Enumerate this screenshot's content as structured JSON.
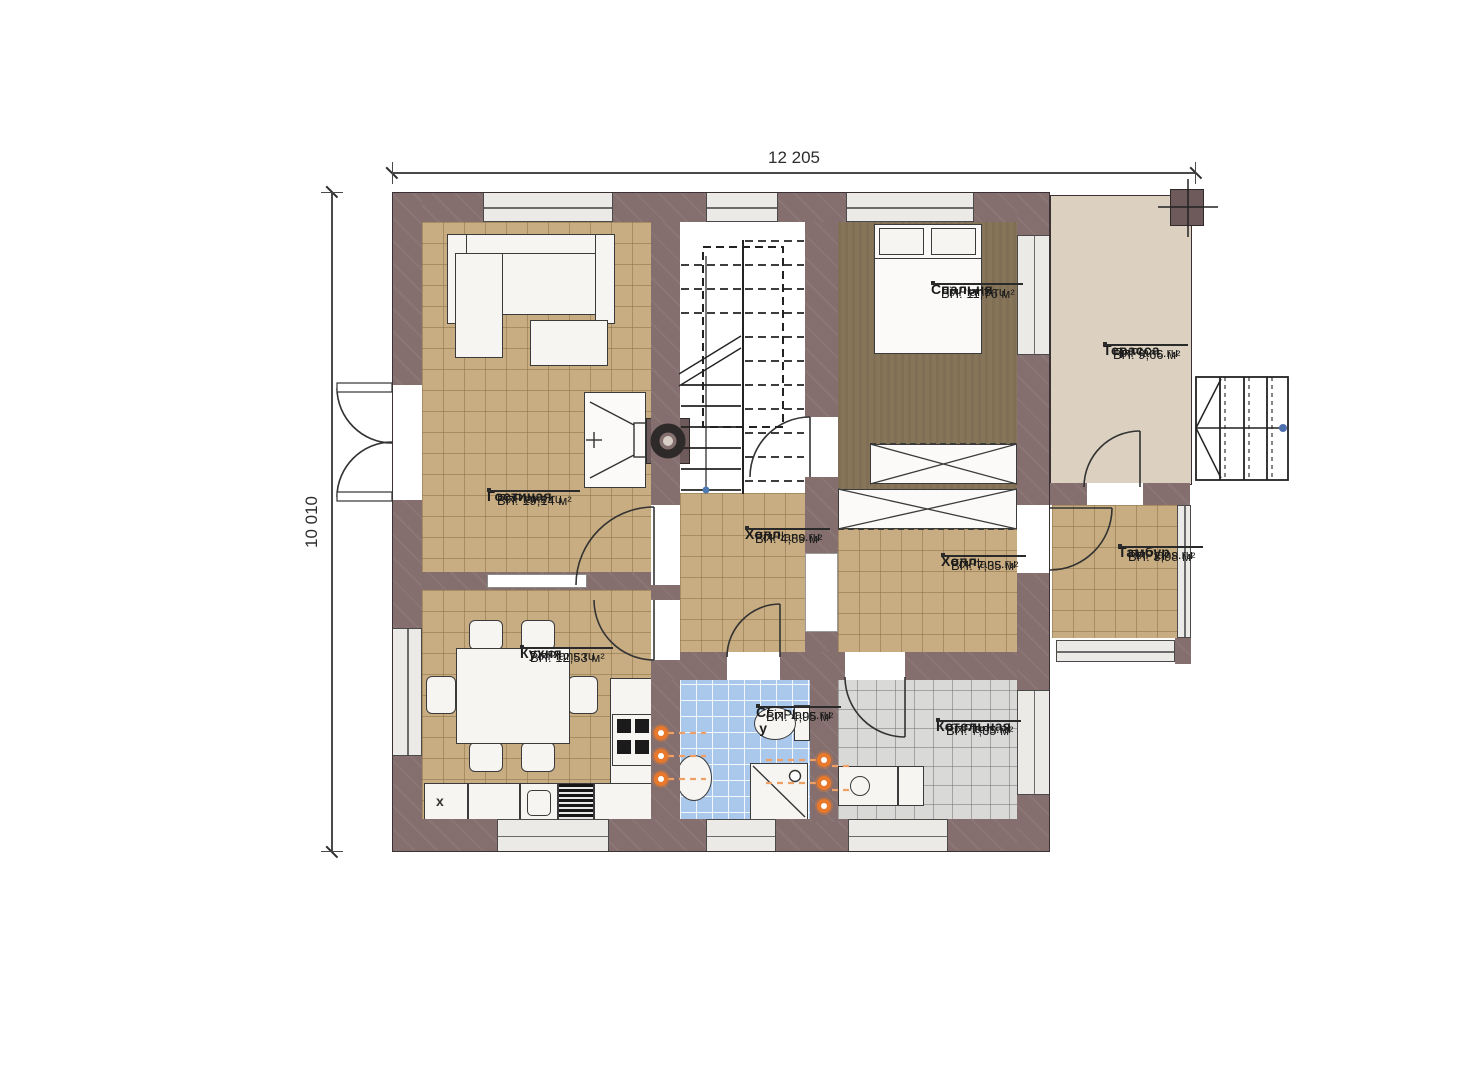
{
  "brand": "FixPlans.ru",
  "dimensions": {
    "width_label": "12 205",
    "height_label": "10 010"
  },
  "rooms": [
    {
      "id": "living",
      "name": "Гостиная",
      "area": "ВП: 19,14 м²"
    },
    {
      "id": "kitchen",
      "name": "Кухня",
      "area": "ВП: 12,53 м²"
    },
    {
      "id": "bedroom",
      "name": "Спальня",
      "area": "ВП: 11,76 м²"
    },
    {
      "id": "terrace",
      "name": "Терасса",
      "area": "ВП: 9,66 м²"
    },
    {
      "id": "hall1",
      "name": "Холл",
      "area": "ВП: 4,89 м²"
    },
    {
      "id": "hall2",
      "name": "Холл",
      "area": "ВП: 7,35 м²"
    },
    {
      "id": "tambur",
      "name": "Тамбур",
      "area": "ВП: 3,98 м²"
    },
    {
      "id": "wc",
      "name": "С/у",
      "area": "ВП: 4,95 м²"
    },
    {
      "id": "boiler",
      "name": "Котельная",
      "area": "ВП: 7,35 м²"
    }
  ],
  "markers": {
    "fridge_label": "х"
  }
}
